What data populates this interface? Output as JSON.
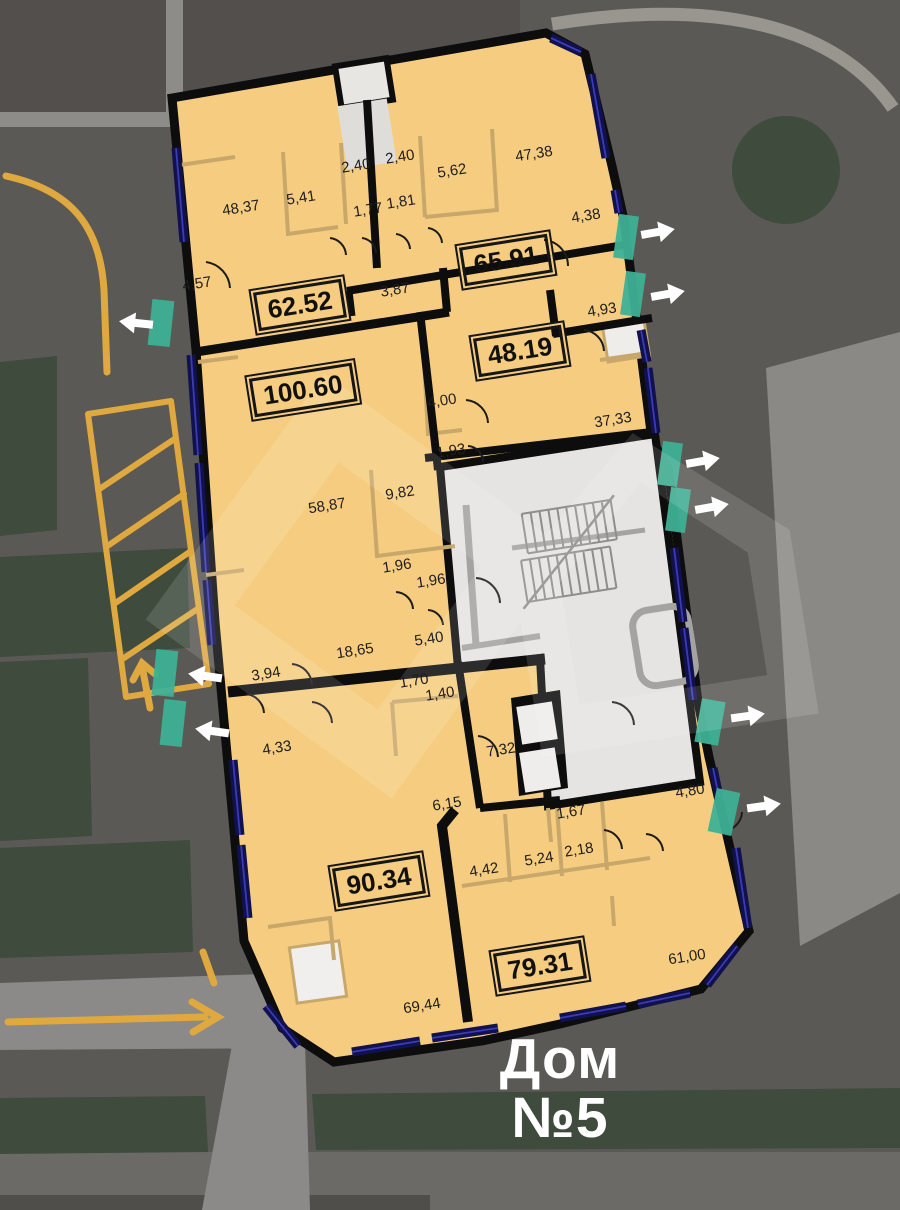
{
  "title": {
    "line1": "Дом",
    "line2": "№5"
  },
  "apartments": [
    {
      "total": "62.52",
      "rooms": [
        "48,37",
        "5,41",
        "2,40",
        "1,77",
        "4,57",
        "3,87"
      ]
    },
    {
      "total": "65.91",
      "rooms": [
        "2,40",
        "5,62",
        "47,38",
        "1,81",
        "4,38",
        "4,93"
      ]
    },
    {
      "total": "48.19",
      "rooms": [
        "4,00",
        "1,93",
        "37,33"
      ]
    },
    {
      "total": "100.60",
      "rooms": [
        "58,87",
        "9,82",
        "1,96",
        "1,96",
        "5,40",
        "18,65",
        "3,94"
      ]
    },
    {
      "total": "90.34",
      "rooms": [
        "4,33",
        "1,70",
        "1,40",
        "7,32",
        "6,15",
        "69,44"
      ]
    },
    {
      "total": "79.31",
      "rooms": [
        "4,42",
        "5,24",
        "2,18",
        "1,67",
        "4,80",
        "61,00"
      ]
    }
  ],
  "colors": {
    "site_background": "#5B5956",
    "landscaping_green": "#3E4B3D",
    "road_gray": "#8B8A88",
    "road_marking_yellow": "#DFA93F",
    "building_fill": "#F6CD80",
    "wall_black": "#0D0D0D",
    "window_navy": "#11114E",
    "entrance_teal": "#3FB295",
    "stair_core_gray": "#E6E4E2",
    "partition_tan": "#C8A76B",
    "arrow_white": "#FFFFFF"
  }
}
